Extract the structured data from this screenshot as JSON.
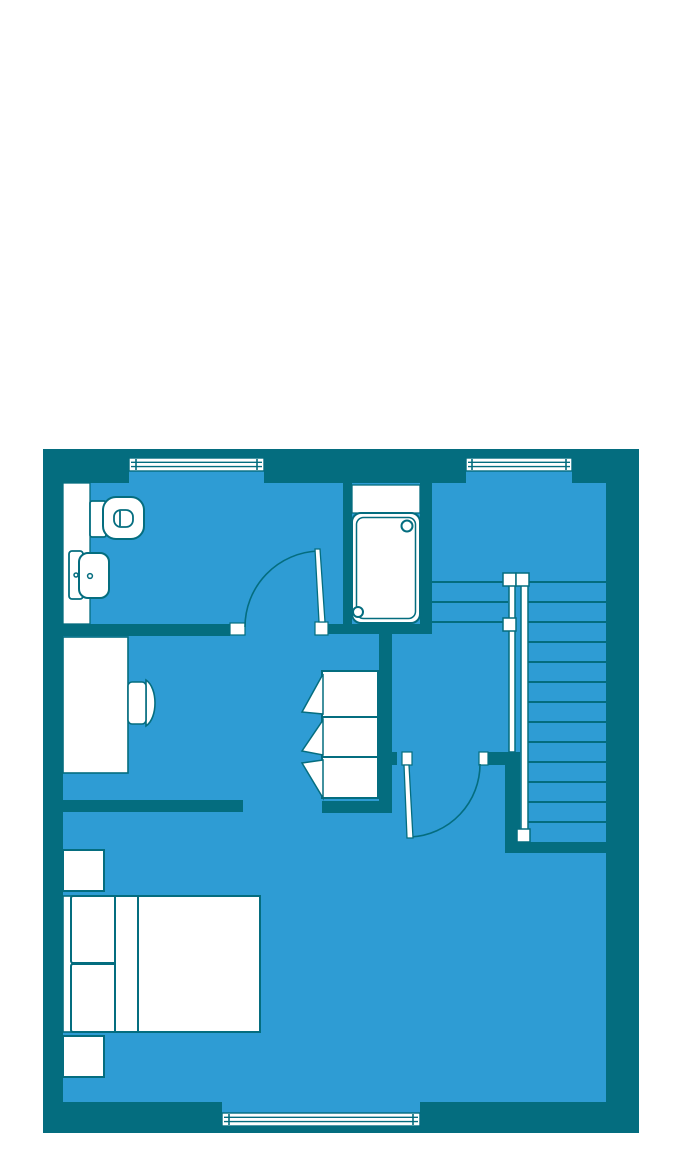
{
  "colors": {
    "paper": "#ffffff",
    "wall": "#046d7f",
    "floor": "#2e9cd4",
    "line": "#046d7f",
    "fixture": "#ffffff"
  },
  "floorplan": {
    "type": "residential-upper-floor",
    "rooms": [
      {
        "name": "bathroom",
        "fixtures": [
          "toilet",
          "sink",
          "vanity-counter",
          "bathtub"
        ]
      },
      {
        "name": "study-area",
        "fixtures": [
          "desk",
          "desk-chair"
        ]
      },
      {
        "name": "hallway",
        "fixtures": [
          "wardrobe-3-door"
        ]
      },
      {
        "name": "stair-landing",
        "fixtures": [
          "staircase",
          "railing"
        ]
      },
      {
        "name": "bedroom",
        "fixtures": [
          "double-bed",
          "nightstand",
          "nightstand"
        ]
      }
    ],
    "windows": {
      "count": 3,
      "positions": [
        "top-left",
        "top-right",
        "bottom-center"
      ]
    },
    "doors": {
      "count": 2,
      "positions": [
        "bathroom",
        "bedroom"
      ]
    },
    "stairs": {
      "straight_treads": 13,
      "winder_treads": 3,
      "railing_posts": 4
    },
    "wardrobe": {
      "doors": 3,
      "swing_symbols": 3
    },
    "bed": {
      "pillows": 2,
      "headboard": true,
      "nightstands": 2
    }
  }
}
